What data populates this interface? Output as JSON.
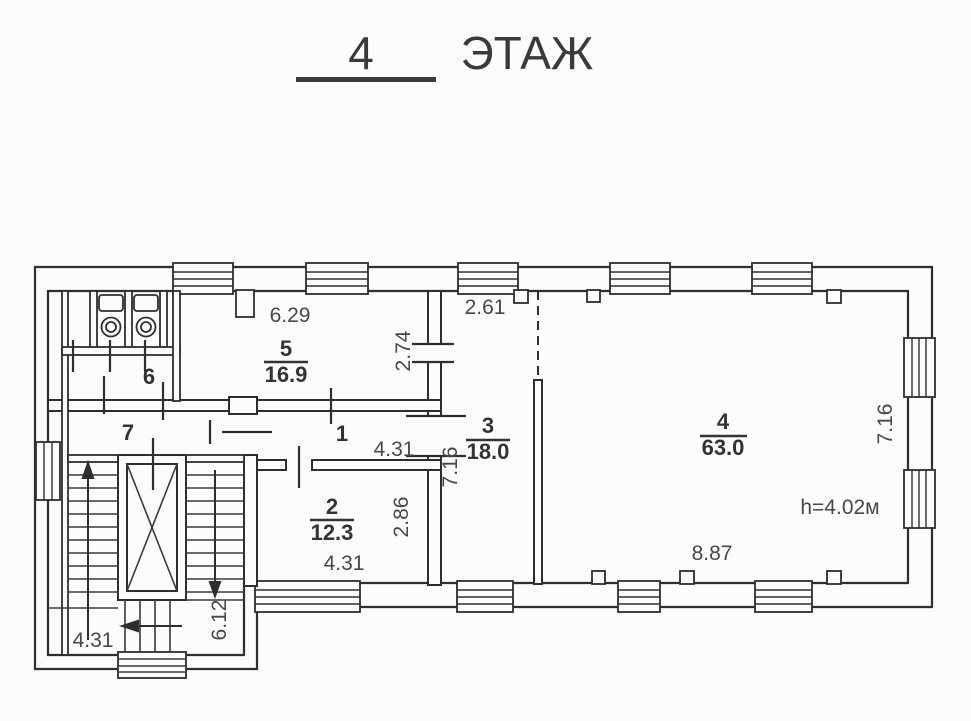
{
  "title": {
    "number": "4",
    "word": "ЭТАЖ"
  },
  "rooms": {
    "room1": {
      "number": "1"
    },
    "room2": {
      "number": "2",
      "area": "12.3"
    },
    "room3": {
      "number": "3",
      "area": "18.0"
    },
    "room4": {
      "number": "4",
      "area": "63.0",
      "ceiling_height": "h=4.02м"
    },
    "room5": {
      "number": "5",
      "area": "16.9"
    },
    "room6": {
      "number": "6"
    },
    "room7": {
      "number": "7"
    }
  },
  "dimensions": {
    "room5_width": "6.29",
    "room5_depth": "2.74",
    "room3_width": "2.61",
    "room3_depth": "7.16",
    "corridor_width": "4.31",
    "room2_depth": "2.86",
    "room2_width": "4.31",
    "room4_width": "8.87",
    "room4_depth": "7.16",
    "stair_bay_width": "4.31",
    "stair_bay_depth": "6.12"
  },
  "colors": {
    "wall_line": "#2e2e2e",
    "dimension_text": "#474747",
    "room_text": "#333333",
    "background": "#fcfcfb"
  }
}
